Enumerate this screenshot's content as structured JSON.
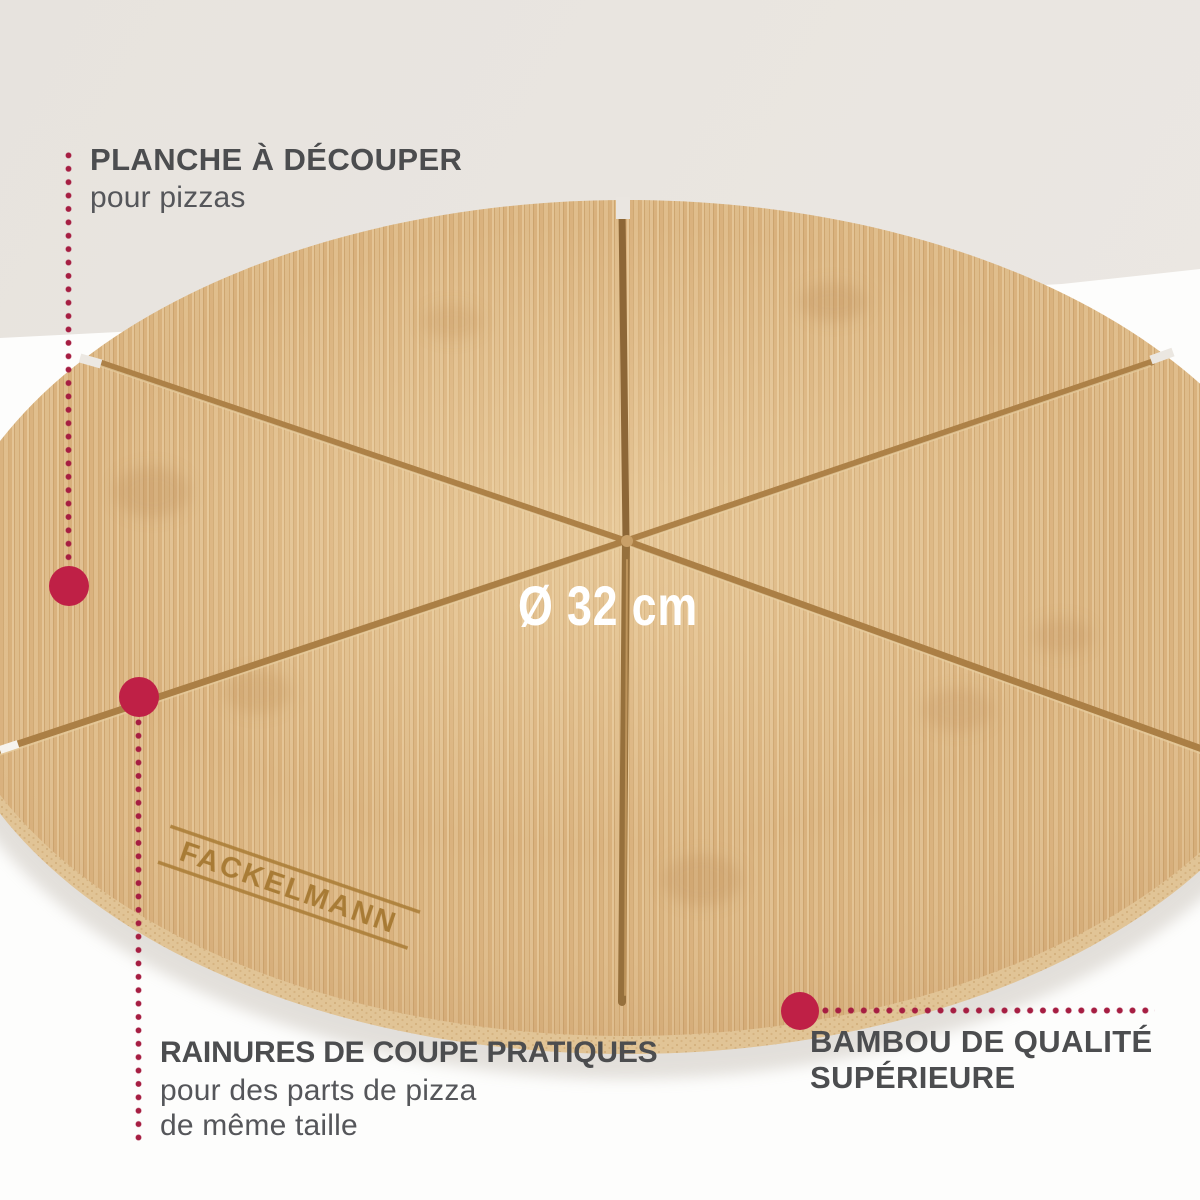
{
  "product": {
    "brand": "FACKELMANN",
    "diameter_label": "Ø 32 cm"
  },
  "annotations": {
    "planche": {
      "title": "PLANCHE À DÉCOUPER",
      "subtitle": "pour pizzas"
    },
    "rainures": {
      "title": "RAINURES DE COUPE PRATIQUES",
      "subtitle_line1": "pour des parts de pizza",
      "subtitle_line2": "de même taille"
    },
    "bambou": {
      "title_line1": "BAMBOU DE QUALITÉ",
      "title_line2": "SUPÉRIEURE"
    }
  },
  "colors": {
    "accent_red": "#bf2046",
    "leader_dot_red": "#a61e42",
    "text_dark": "#4c4d4f",
    "wood_light": "#e2c192",
    "wood_dark": "#cda572",
    "groove_brown": "#a87c42",
    "background_beige": "#e9e5e0",
    "background_white": "#fdfdfc",
    "diameter_text": "#ffffff"
  }
}
